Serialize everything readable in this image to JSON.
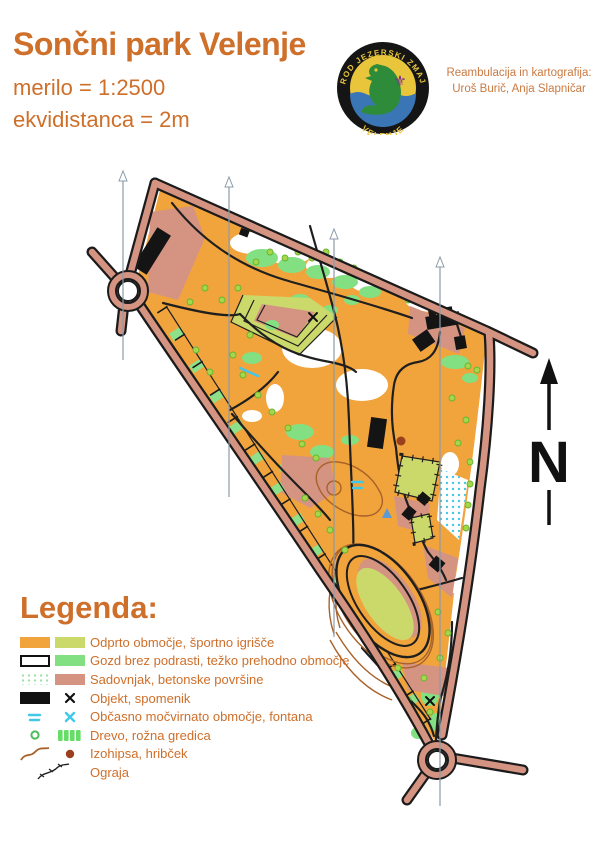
{
  "header": {
    "title": "Sončni park Velenje",
    "scale": "merilo = 1:2500",
    "equidistance": "ekvidistanca = 2m",
    "attribution_line1": "Reambulacija in kartografija:",
    "attribution_line2": "Uroš Burič, Anja Slapničar"
  },
  "logo": {
    "text_top": "ROD JEZERSKI ZMAJ",
    "text_bottom": "VELENJE",
    "fleur_icon": "⚜"
  },
  "north_arrow": {
    "label": "N"
  },
  "legend": {
    "title": "Legenda:",
    "items": [
      {
        "label": "Odprto območje, športno igrišče"
      },
      {
        "label": "Gozd brez podrasti, težko prehodno območje"
      },
      {
        "label": "Sadovnjak, betonske površine"
      },
      {
        "label": "Objekt, spomenik"
      },
      {
        "label": "Občasno močvirnato območje, fontana"
      },
      {
        "label": "Drevo, rožna gredica"
      },
      {
        "label": "Izohipsa, hribček"
      },
      {
        "label": "Ograja"
      }
    ]
  },
  "colors": {
    "accent_text": "#CE6F2A",
    "attrib_text": "#C97B43",
    "open_area": "#F2A43C",
    "sport_field": "#CBD96B",
    "forest_open": "#FFFFFF",
    "rough_open": "#82E082",
    "paved": "#D59482",
    "marsh": "#41C7E8",
    "tree": "#A5D64C",
    "contour": "#A8622A",
    "object": "#141414",
    "road_casing": "#1B1B1B",
    "meridian": "#8C9BA8",
    "badge_yellow": "#E9C53C",
    "badge_water": "#3A76B5",
    "badge_dragon": "#2E8B3A",
    "badge_fleur": "#7B2F8F"
  }
}
